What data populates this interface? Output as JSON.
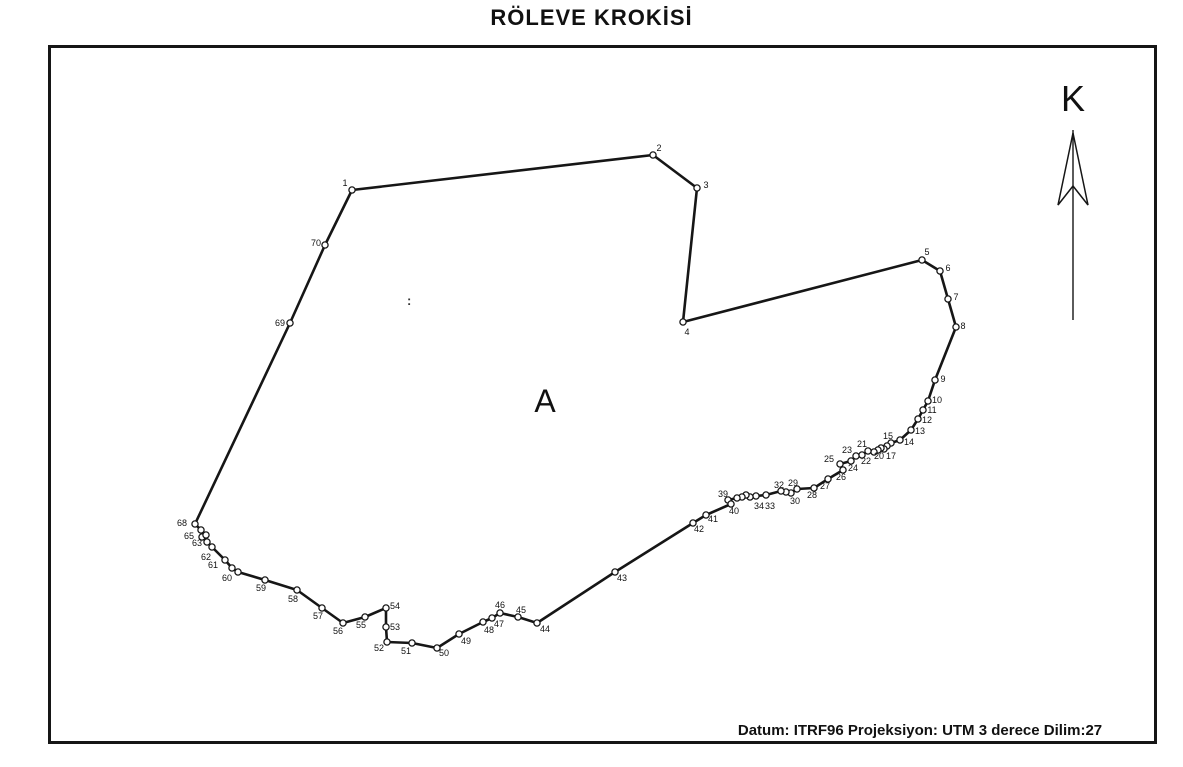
{
  "title": "RÖLEVE KROKİSİ",
  "north": {
    "label": "K"
  },
  "area_label": "A",
  "footer": "Datum: ITRF96 Projeksiyon: UTM 3 derece Dilim:27",
  "artifact": ":",
  "colors": {
    "ink": "#161616",
    "paper": "#ffffff"
  },
  "chart_data": {
    "type": "table",
    "title": "RÖLEVE KROKİSİ",
    "notes": "Closed cadastral traverse polygon, vertices numbered 1-70 clockwise; labels 16,18,19,31,35,36,37,38,64,66,67 obscured by overlap",
    "parcel": {
      "closed": true,
      "points": [
        {
          "n": "1",
          "x": 352,
          "y": 190,
          "lx": 345,
          "ly": 186,
          "show": true
        },
        {
          "n": "2",
          "x": 653,
          "y": 155,
          "lx": 659,
          "ly": 151,
          "show": true
        },
        {
          "n": "3",
          "x": 697,
          "y": 188,
          "lx": 706,
          "ly": 188,
          "show": true
        },
        {
          "n": "4",
          "x": 683,
          "y": 322,
          "lx": 687,
          "ly": 335,
          "show": true
        },
        {
          "n": "5",
          "x": 922,
          "y": 260,
          "lx": 927,
          "ly": 255,
          "show": true
        },
        {
          "n": "6",
          "x": 940,
          "y": 271,
          "lx": 948,
          "ly": 271,
          "show": true
        },
        {
          "n": "7",
          "x": 948,
          "y": 299,
          "lx": 956,
          "ly": 300,
          "show": true
        },
        {
          "n": "8",
          "x": 956,
          "y": 327,
          "lx": 963,
          "ly": 329,
          "show": true
        },
        {
          "n": "9",
          "x": 935,
          "y": 380,
          "lx": 943,
          "ly": 382,
          "show": true
        },
        {
          "n": "10",
          "x": 928,
          "y": 401,
          "lx": 937,
          "ly": 403,
          "show": true
        },
        {
          "n": "11",
          "x": 923,
          "y": 410,
          "lx": 932,
          "ly": 413,
          "show": true
        },
        {
          "n": "12",
          "x": 918,
          "y": 419,
          "lx": 927,
          "ly": 423,
          "show": true
        },
        {
          "n": "13",
          "x": 911,
          "y": 430,
          "lx": 920,
          "ly": 434,
          "show": true
        },
        {
          "n": "14",
          "x": 900,
          "y": 440,
          "lx": 909,
          "ly": 445,
          "show": true
        },
        {
          "n": "15",
          "x": 891,
          "y": 443,
          "lx": 888,
          "ly": 439,
          "show": true
        },
        {
          "n": "16",
          "x": 887,
          "y": 446,
          "lx": 887,
          "ly": 446,
          "show": false
        },
        {
          "n": "17",
          "x": 884,
          "y": 449,
          "lx": 891,
          "ly": 459,
          "show": true
        },
        {
          "n": "18",
          "x": 881,
          "y": 448,
          "lx": 881,
          "ly": 448,
          "show": false
        },
        {
          "n": "19",
          "x": 878,
          "y": 450,
          "lx": 878,
          "ly": 450,
          "show": false
        },
        {
          "n": "20",
          "x": 874,
          "y": 452,
          "lx": 879,
          "ly": 459,
          "show": true
        },
        {
          "n": "21",
          "x": 868,
          "y": 451,
          "lx": 862,
          "ly": 447,
          "show": true
        },
        {
          "n": "22",
          "x": 862,
          "y": 455,
          "lx": 866,
          "ly": 464,
          "show": true
        },
        {
          "n": "23",
          "x": 856,
          "y": 456,
          "lx": 847,
          "ly": 453,
          "show": true
        },
        {
          "n": "24",
          "x": 851,
          "y": 461,
          "lx": 853,
          "ly": 471,
          "show": true
        },
        {
          "n": "25",
          "x": 840,
          "y": 464,
          "lx": 829,
          "ly": 462,
          "show": true
        },
        {
          "n": "26",
          "x": 843,
          "y": 470,
          "lx": 841,
          "ly": 480,
          "show": true
        },
        {
          "n": "27",
          "x": 828,
          "y": 479,
          "lx": 825,
          "ly": 489,
          "show": true
        },
        {
          "n": "28",
          "x": 814,
          "y": 488,
          "lx": 812,
          "ly": 498,
          "show": true
        },
        {
          "n": "29",
          "x": 797,
          "y": 489,
          "lx": 793,
          "ly": 486,
          "show": true
        },
        {
          "n": "30",
          "x": 791,
          "y": 493,
          "lx": 795,
          "ly": 504,
          "show": true
        },
        {
          "n": "31",
          "x": 786,
          "y": 492,
          "lx": 786,
          "ly": 492,
          "show": false
        },
        {
          "n": "32",
          "x": 781,
          "y": 491,
          "lx": 779,
          "ly": 488,
          "show": true
        },
        {
          "n": "33",
          "x": 766,
          "y": 495,
          "lx": 770,
          "ly": 509,
          "show": true
        },
        {
          "n": "34",
          "x": 756,
          "y": 496,
          "lx": 759,
          "ly": 509,
          "show": true
        },
        {
          "n": "35",
          "x": 750,
          "y": 497,
          "lx": 750,
          "ly": 497,
          "show": false
        },
        {
          "n": "36",
          "x": 746,
          "y": 495,
          "lx": 746,
          "ly": 495,
          "show": false
        },
        {
          "n": "37",
          "x": 742,
          "y": 497,
          "lx": 742,
          "ly": 497,
          "show": false
        },
        {
          "n": "38",
          "x": 737,
          "y": 498,
          "lx": 737,
          "ly": 498,
          "show": false
        },
        {
          "n": "39",
          "x": 728,
          "y": 500,
          "lx": 723,
          "ly": 497,
          "show": true
        },
        {
          "n": "40",
          "x": 731,
          "y": 504,
          "lx": 734,
          "ly": 514,
          "show": true
        },
        {
          "n": "41",
          "x": 706,
          "y": 515,
          "lx": 713,
          "ly": 522,
          "show": true
        },
        {
          "n": "42",
          "x": 693,
          "y": 523,
          "lx": 699,
          "ly": 532,
          "show": true
        },
        {
          "n": "43",
          "x": 615,
          "y": 572,
          "lx": 622,
          "ly": 581,
          "show": true
        },
        {
          "n": "44",
          "x": 537,
          "y": 623,
          "lx": 545,
          "ly": 632,
          "show": true
        },
        {
          "n": "45",
          "x": 518,
          "y": 617,
          "lx": 521,
          "ly": 613,
          "show": true
        },
        {
          "n": "46",
          "x": 500,
          "y": 613,
          "lx": 500,
          "ly": 608,
          "show": true
        },
        {
          "n": "47",
          "x": 492,
          "y": 618,
          "lx": 499,
          "ly": 627,
          "show": true
        },
        {
          "n": "48",
          "x": 483,
          "y": 622,
          "lx": 489,
          "ly": 633,
          "show": true
        },
        {
          "n": "49",
          "x": 459,
          "y": 634,
          "lx": 466,
          "ly": 644,
          "show": true
        },
        {
          "n": "50",
          "x": 437,
          "y": 648,
          "lx": 444,
          "ly": 656,
          "show": true
        },
        {
          "n": "51",
          "x": 412,
          "y": 643,
          "lx": 406,
          "ly": 654,
          "show": true
        },
        {
          "n": "52",
          "x": 387,
          "y": 642,
          "lx": 379,
          "ly": 651,
          "show": true
        },
        {
          "n": "53",
          "x": 386,
          "y": 627,
          "lx": 395,
          "ly": 630,
          "show": true
        },
        {
          "n": "54",
          "x": 386,
          "y": 608,
          "lx": 395,
          "ly": 609,
          "show": true
        },
        {
          "n": "55",
          "x": 365,
          "y": 617,
          "lx": 361,
          "ly": 628,
          "show": true
        },
        {
          "n": "56",
          "x": 343,
          "y": 623,
          "lx": 338,
          "ly": 634,
          "show": true
        },
        {
          "n": "57",
          "x": 322,
          "y": 608,
          "lx": 318,
          "ly": 619,
          "show": true
        },
        {
          "n": "58",
          "x": 297,
          "y": 590,
          "lx": 293,
          "ly": 602,
          "show": true
        },
        {
          "n": "59",
          "x": 265,
          "y": 580,
          "lx": 261,
          "ly": 591,
          "show": true
        },
        {
          "n": "60",
          "x": 238,
          "y": 572,
          "lx": 227,
          "ly": 581,
          "show": true
        },
        {
          "n": "61",
          "x": 232,
          "y": 568,
          "lx": 213,
          "ly": 568,
          "show": true
        },
        {
          "n": "62",
          "x": 225,
          "y": 560,
          "lx": 206,
          "ly": 560,
          "show": true
        },
        {
          "n": "63",
          "x": 212,
          "y": 547,
          "lx": 197,
          "ly": 546,
          "show": true
        },
        {
          "n": "64",
          "x": 207,
          "y": 542,
          "lx": 207,
          "ly": 542,
          "show": false
        },
        {
          "n": "65",
          "x": 202,
          "y": 537,
          "lx": 189,
          "ly": 539,
          "show": true
        },
        {
          "n": "66",
          "x": 206,
          "y": 535,
          "lx": 206,
          "ly": 535,
          "show": false
        },
        {
          "n": "67",
          "x": 201,
          "y": 530,
          "lx": 201,
          "ly": 530,
          "show": false
        },
        {
          "n": "68",
          "x": 195,
          "y": 524,
          "lx": 182,
          "ly": 526,
          "show": true
        },
        {
          "n": "69",
          "x": 290,
          "y": 323,
          "lx": 280,
          "ly": 326,
          "show": true
        },
        {
          "n": "70",
          "x": 325,
          "y": 245,
          "lx": 316,
          "ly": 246,
          "show": true
        }
      ]
    },
    "north_arrow": {
      "x": 1073,
      "line_top": 130,
      "line_bottom": 320,
      "head": {
        "tip_y": 133,
        "base_y": 205,
        "half_width": 15,
        "notch_y": 186
      }
    }
  }
}
